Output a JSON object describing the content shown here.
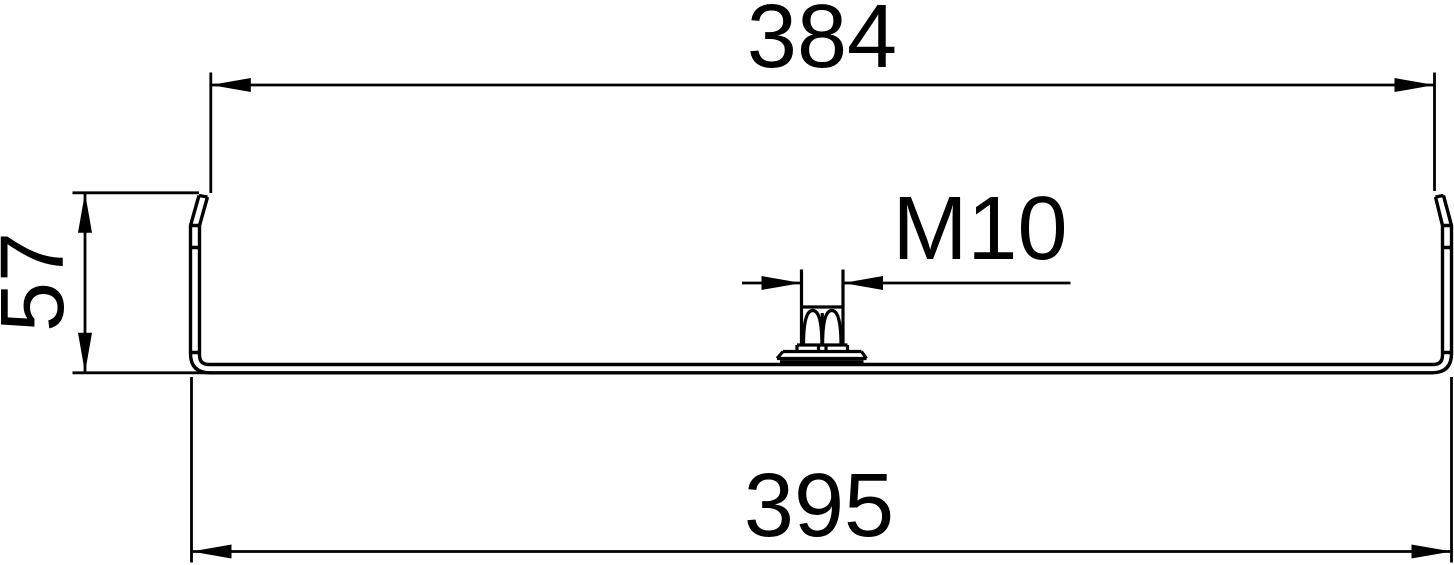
{
  "colors": {
    "background": "#ffffff",
    "line": "#000000",
    "text": "#000000"
  },
  "labels": {
    "width_top": "384",
    "height_left": "57",
    "thread": "M10",
    "width_bottom": "395"
  }
}
